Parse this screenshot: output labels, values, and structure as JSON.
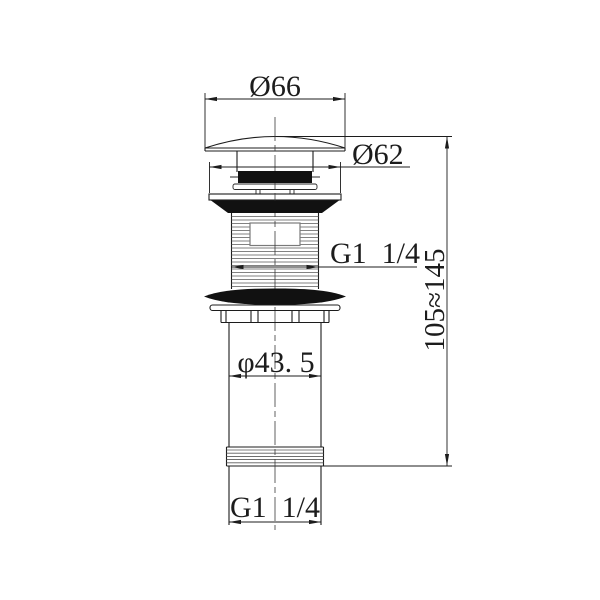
{
  "labels": {
    "cap_diameter": "Ø66",
    "flange_diameter": "Ø62",
    "top_thread_size": "G1  1/4",
    "height_range": "105≈145",
    "body_diameter": "φ43. 5",
    "bottom_thread_size": "G1  1/4"
  },
  "colors": {
    "background": "#ffffff",
    "line": "#1c1c1c",
    "thread_line": "#5a5a5a",
    "solid_fill": "#111111"
  }
}
